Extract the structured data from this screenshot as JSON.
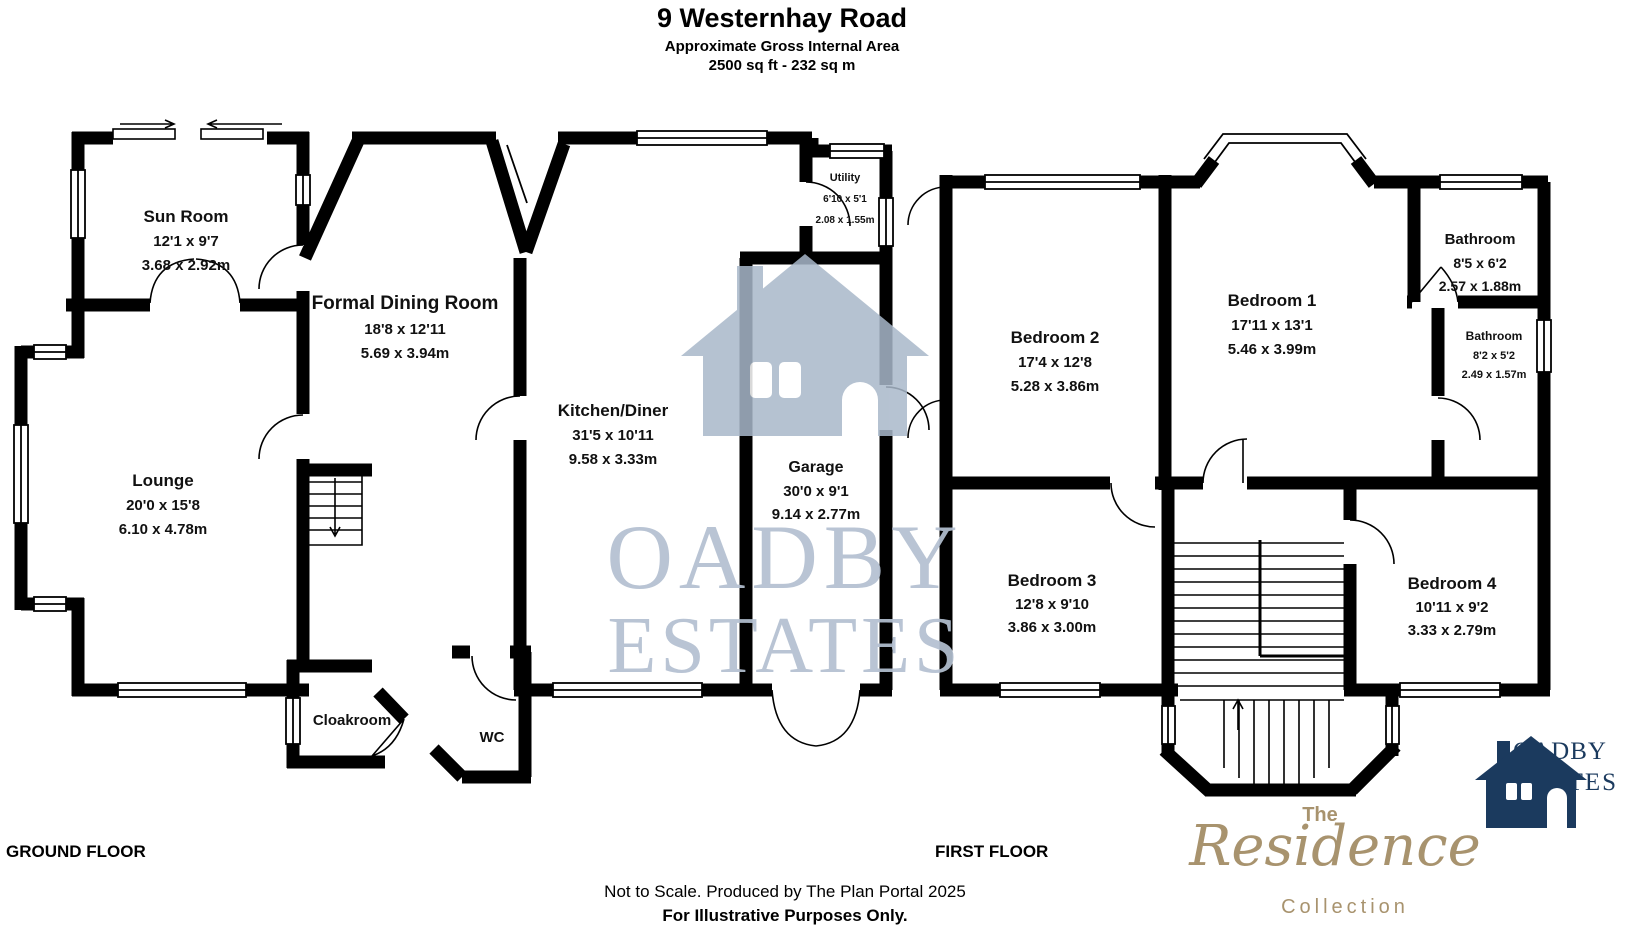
{
  "header": {
    "title": "9 Westernhay Road",
    "subtitle": "Approximate Gross Internal Area",
    "area": "2500 sq ft - 232 sq m"
  },
  "ground_floor": {
    "label": "GROUND FLOOR",
    "rooms": [
      {
        "name": "Sun Room",
        "imperial": "12'1 x 9'7",
        "metric": "3.68 x 2.92m"
      },
      {
        "name": "Formal Dining Room",
        "imperial": "18'8 x 12'11",
        "metric": "5.69 x 3.94m"
      },
      {
        "name": "Lounge",
        "imperial": "20'0 x 15'8",
        "metric": "6.10 x 4.78m"
      },
      {
        "name": "Kitchen/Diner",
        "imperial": "31'5 x 10'11",
        "metric": "9.58 x 3.33m"
      },
      {
        "name": "Utility",
        "imperial": "6'10 x 5'1",
        "metric": "2.08 x 1.55m"
      },
      {
        "name": "Garage",
        "imperial": "30'0 x 9'1",
        "metric": "9.14 x 2.77m"
      },
      {
        "name": "Cloakroom"
      },
      {
        "name": "WC"
      }
    ]
  },
  "first_floor": {
    "label": "FIRST FLOOR",
    "rooms": [
      {
        "name": "Bedroom 2",
        "imperial": "17'4 x 12'8",
        "metric": "5.28 x 3.86m"
      },
      {
        "name": "Bedroom 1",
        "imperial": "17'11 x 13'1",
        "metric": "5.46 x 3.99m"
      },
      {
        "name": "Bathroom",
        "imperial": "8'5 x 6'2",
        "metric": "2.57 x 1.88m"
      },
      {
        "name": "Bathroom",
        "imperial": "8'2 x 5'2",
        "metric": "2.49 x 1.57m"
      },
      {
        "name": "Bedroom 3",
        "imperial": "12'8 x 9'10",
        "metric": "3.86 x 3.00m"
      },
      {
        "name": "Bedroom 4",
        "imperial": "10'11 x 9'2",
        "metric": "3.33 x 2.79m"
      }
    ]
  },
  "footer": {
    "line1": "Not to Scale. Produced by The Plan Portal 2025",
    "line2": "For Illustrative Purposes Only."
  },
  "watermark": {
    "line1": "OADBY",
    "line2": "ESTATES",
    "text_color": "#b4c0d1",
    "house_color": "#a9b8ca"
  },
  "logos": {
    "residence": {
      "the": "The",
      "name": "Residence",
      "collection": "Collection",
      "color": "#a8936e"
    },
    "oadby": {
      "line1": "OADBY",
      "line2": "ESTATES",
      "color": "#1b3a5e"
    }
  }
}
